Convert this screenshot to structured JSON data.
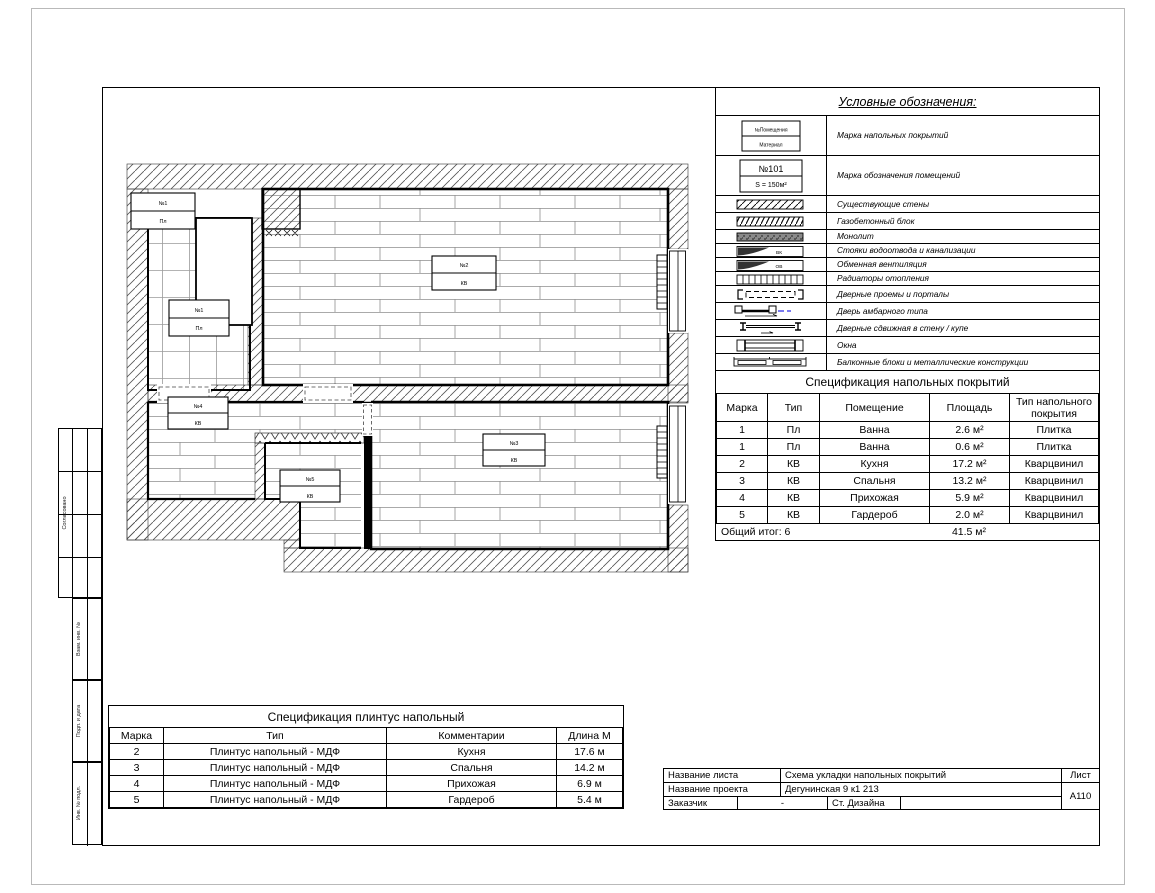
{
  "legend": {
    "title": "Условные обозначения:",
    "items": [
      {
        "label": "Марка напольных покрытий",
        "box_top": "№Помещения",
        "box_bottom": "Материал"
      },
      {
        "label": "Марка обозначения помещений",
        "box_top": "№101",
        "box_bottom": "S = 150м²"
      },
      {
        "label": "Существующие стены"
      },
      {
        "label": "Газобетонный блок"
      },
      {
        "label": "Монолит"
      },
      {
        "label": "Стояки водоотвода и канализации",
        "symbol_text": "ВК"
      },
      {
        "label": "Обменная вентиляция",
        "symbol_text": "ОВ"
      },
      {
        "label": "Радиаторы отопления"
      },
      {
        "label": "Дверные проемы и порталы"
      },
      {
        "label": "Дверь амбарного типа"
      },
      {
        "label": "Дверные сдвижная в стену / купе"
      },
      {
        "label": "Окна"
      },
      {
        "label": "Балконные блоки и металлические конструкции"
      }
    ]
  },
  "floor_spec": {
    "title": "Спецификация напольных покрытий",
    "headers": [
      "Марка",
      "Тип",
      "Помещение",
      "Площадь",
      "Тип напольного покрытия"
    ],
    "rows": [
      [
        "1",
        "Пл",
        "Ванна",
        "2.6 м²",
        "Плитка"
      ],
      [
        "1",
        "Пл",
        "Ванна",
        "0.6 м²",
        "Плитка"
      ],
      [
        "2",
        "КВ",
        "Кухня",
        "17.2 м²",
        "Кварцвинил"
      ],
      [
        "3",
        "КВ",
        "Спальня",
        "13.2 м²",
        "Кварцвинил"
      ],
      [
        "4",
        "КВ",
        "Прихожая",
        "5.9 м²",
        "Кварцвинил"
      ],
      [
        "5",
        "КВ",
        "Гардероб",
        "2.0 м²",
        "Кварцвинил"
      ]
    ],
    "total_label": "Общий итог: 6",
    "total_area": "41.5 м²"
  },
  "skirting_spec": {
    "title": "Спецификация плинтус напольный",
    "headers": [
      "Марка",
      "Тип",
      "Комментарии",
      "Длина М"
    ],
    "rows": [
      [
        "2",
        "Плинтус напольный - МДФ",
        "Кухня",
        "17.6 м"
      ],
      [
        "3",
        "Плинтус напольный - МДФ",
        "Спальня",
        "14.2 м"
      ],
      [
        "4",
        "Плинтус напольный - МДФ",
        "Прихожая",
        "6.9 м"
      ],
      [
        "5",
        "Плинтус напольный - МДФ",
        "Гардероб",
        "5.4 м"
      ]
    ]
  },
  "title_block": {
    "sheet_name_label": "Название листа",
    "sheet_name": "Схема укладки напольных покрытий",
    "project_name_label": "Название проекта",
    "project_name": "Дегунинская 9 к1 213",
    "client_label": "Заказчик",
    "client_value": "-",
    "studio": "Ст. Дизайна",
    "sheet_label": "Лист",
    "sheet_number": "A110"
  },
  "side_stamp": {
    "approved": "Согласовано",
    "subst_inv": "Взам. инв. №",
    "sign_date": "Подп. и дата",
    "inv_orig": "Инв. № подл."
  },
  "plan": {
    "labels": [
      {
        "mark": "№1",
        "type": "Пл"
      },
      {
        "mark": "№1",
        "type": "Пл"
      },
      {
        "mark": "№2",
        "type": "КВ"
      },
      {
        "mark": "№4",
        "type": "КВ"
      },
      {
        "mark": "№5",
        "type": "КВ"
      },
      {
        "mark": "№3",
        "type": "КВ"
      }
    ]
  }
}
